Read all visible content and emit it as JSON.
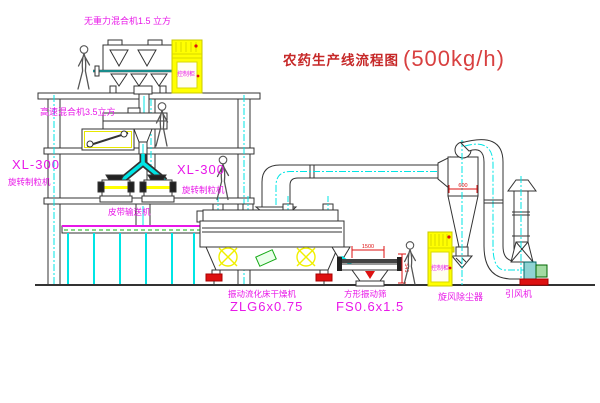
{
  "title": {
    "main": "农药生产线流程图",
    "capacity": "(500kg/h)"
  },
  "equipment": {
    "top_mixer": {
      "label": "无重力混合机1.5 立方"
    },
    "mid_mixer": {
      "label": "高速混合机3.5立方"
    },
    "granulator_left": {
      "model": "XL-300",
      "name": "旋转制粒机"
    },
    "granulator_right": {
      "model": "XL-300",
      "name": "旋转制粒机"
    },
    "conveyor": {
      "name": "皮带输送机"
    },
    "dryer": {
      "name": "振动流化床干燥机",
      "model": "ZLG6x0.75"
    },
    "sieve": {
      "name": "方形振动筛",
      "model": "FS0.6x1.5"
    },
    "cyclone": {
      "name": "旋风除尘器"
    },
    "fan": {
      "name": "引风机"
    }
  },
  "cabinets": {
    "text": "控制柜"
  },
  "dims": {
    "sieve_width": "1500",
    "sieve_height": "541",
    "cyclone_width": "600"
  },
  "colors": {
    "label_magenta": "#e818e8",
    "title_red": "#c62828",
    "dimension_red": "#dd1111",
    "line_dark": "#333333",
    "centerline_cyan": "#00e5e5",
    "cabinet_yellow": "#ffff00",
    "machine_green": "#13a913"
  }
}
